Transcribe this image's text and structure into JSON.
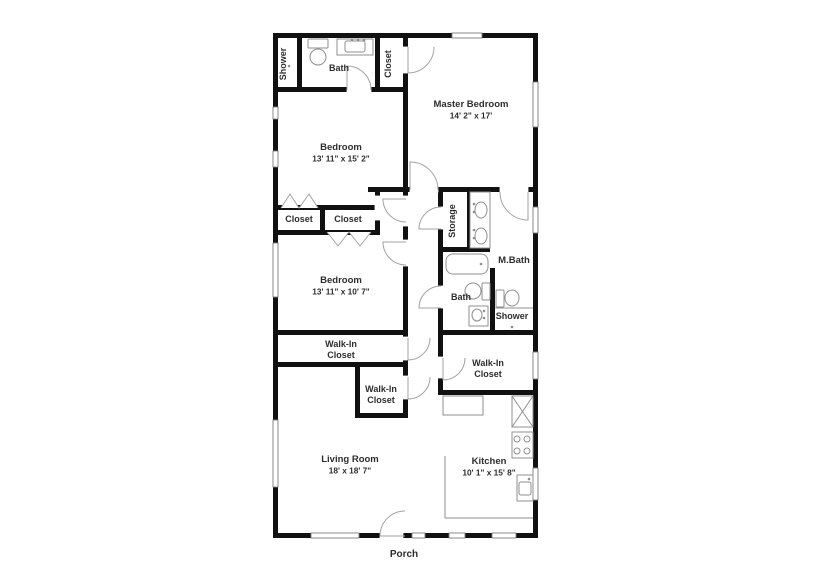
{
  "page": {
    "background": "#ffffff",
    "type": "floor-plan"
  },
  "plan": {
    "colors": {
      "wall": "#111111",
      "fixture": "#8f8f8f",
      "door": "#a3a3a3",
      "window_stroke": "#7d7d7d",
      "text": "#2d2d2d",
      "bg": "#ffffff"
    },
    "walls": [
      [
        273,
        33,
        265,
        5
      ],
      [
        273,
        533,
        265,
        5
      ],
      [
        273,
        33,
        5,
        505
      ],
      [
        533,
        33,
        5,
        505
      ],
      [
        297,
        38,
        5,
        54
      ],
      [
        375,
        38,
        5,
        54
      ],
      [
        403,
        38,
        5,
        380
      ],
      [
        273,
        87,
        130,
        5
      ],
      [
        368,
        187,
        40,
        5
      ],
      [
        375,
        187,
        5,
        48
      ],
      [
        273,
        205,
        105,
        5
      ],
      [
        273,
        230,
        105,
        5
      ],
      [
        320,
        205,
        5,
        30
      ],
      [
        403,
        187,
        135,
        5
      ],
      [
        438,
        190,
        5,
        205
      ],
      [
        467,
        192,
        5,
        58
      ],
      [
        438,
        247,
        52,
        5
      ],
      [
        490,
        268,
        5,
        67
      ],
      [
        273,
        330,
        135,
        5
      ],
      [
        438,
        330,
        100,
        5
      ],
      [
        273,
        362,
        135,
        5
      ],
      [
        355,
        367,
        5,
        51
      ],
      [
        355,
        413,
        53,
        5
      ],
      [
        438,
        390,
        100,
        5
      ]
    ],
    "gaps": [
      [
        403,
        47,
        5,
        26
      ],
      [
        347,
        87,
        24,
        5
      ],
      [
        410,
        187,
        28,
        5
      ],
      [
        500,
        187,
        28,
        5
      ],
      [
        375,
        196,
        5,
        24
      ],
      [
        403,
        196,
        5,
        30
      ],
      [
        403,
        240,
        5,
        26
      ],
      [
        438,
        207,
        5,
        22
      ],
      [
        438,
        286,
        5,
        22
      ],
      [
        403,
        337,
        5,
        23
      ],
      [
        403,
        376,
        5,
        23
      ],
      [
        438,
        357,
        5,
        21
      ],
      [
        380,
        533,
        23,
        5
      ]
    ],
    "windows": [
      [
        452,
        33,
        30,
        5
      ],
      [
        273,
        107,
        5,
        12
      ],
      [
        273,
        151,
        5,
        16
      ],
      [
        273,
        243,
        5,
        54
      ],
      [
        273,
        420,
        5,
        67
      ],
      [
        533,
        82,
        5,
        45
      ],
      [
        533,
        207,
        5,
        26
      ],
      [
        533,
        352,
        5,
        27
      ],
      [
        533,
        468,
        5,
        32
      ],
      [
        311,
        533,
        48,
        5
      ],
      [
        412,
        533,
        13,
        5
      ],
      [
        449,
        533,
        16,
        5
      ],
      [
        492,
        533,
        24,
        5
      ]
    ],
    "doors": [
      "M 408 47 L 408 73 A 26 26 0 0 0 434 47",
      "M 347 90 L 347 66 A 24 24 0 0 1 371 90",
      "M 410 190 L 410 162 A 28 28 0 0 1 438 190",
      "M 528 192 L 528 220 A 28 28 0 0 1 500 192",
      "M 406 199 L 383 199 A 23 23 0 0 0 406 222",
      "M 406 242 L 383 242 A 23 23 0 0 0 406 265",
      "M 441 229 L 419 229 A 22 22 0 0 1 441 207",
      "M 441 308 L 419 308 A 22 22 0 0 1 441 286",
      "M 408 338 L 408 360 A 22 22 0 0 0 430 338",
      "M 408 377 L 408 399 A 22 22 0 0 0 430 377",
      "M 443 358 L 443 380 A 22 22 0 0 0 465 358",
      "M 405 536 L 380 536 A 25 25 0 0 1 405 511"
    ],
    "bifold_doors": [
      "281,208 290,194 299,208 309,194 318,208",
      "327,232 338,246 349,232 360,246 371,232"
    ],
    "fixtures": {
      "rects": [
        [
          308,
          39,
          20,
          9,
          1
        ],
        [
          337,
          39,
          36,
          16,
          0
        ],
        [
          345,
          41,
          20,
          11,
          2
        ],
        [
          470,
          192,
          20,
          56,
          0
        ],
        [
          446,
          254,
          42,
          20,
          7
        ],
        [
          482,
          283,
          8,
          17,
          1
        ],
        [
          496,
          290,
          8,
          17,
          1
        ],
        [
          469,
          306,
          19,
          20,
          0
        ],
        [
          512,
          396,
          21,
          31,
          0
        ],
        [
          512,
          432,
          21,
          26,
          0
        ],
        [
          517,
          475,
          16,
          26,
          0
        ],
        [
          519,
          482,
          12,
          13,
          2
        ],
        [
          443,
          396,
          40,
          19,
          0
        ]
      ],
      "ellipses": [
        [
          318,
          57,
          8,
          8
        ],
        [
          481,
          210,
          6,
          8
        ],
        [
          481,
          236,
          6,
          8
        ],
        [
          473,
          291,
          8,
          8
        ],
        [
          512,
          298,
          7,
          8
        ],
        [
          477,
          315,
          5,
          6
        ]
      ],
      "circles": [
        [
          517,
          439,
          3
        ],
        [
          527,
          439,
          3
        ],
        [
          517,
          451,
          3
        ],
        [
          527,
          451,
          3
        ]
      ],
      "lines": [
        [
          495,
          308,
          533,
          308
        ],
        [
          512,
          396,
          533,
          427
        ],
        [
          533,
          396,
          512,
          427
        ]
      ],
      "polylines": [
        "445,456 445,518 533,518"
      ],
      "dots": [
        [
          289,
          66
        ],
        [
          512,
          327
        ],
        [
          481,
          264
        ],
        [
          474,
          204
        ],
        [
          474,
          212
        ],
        [
          474,
          230
        ],
        [
          474,
          238
        ],
        [
          484,
          311
        ],
        [
          484,
          318
        ],
        [
          352,
          40
        ],
        [
          358,
          40
        ],
        [
          364,
          40
        ],
        [
          529,
          479
        ]
      ]
    },
    "rooms": [
      {
        "id": "shower-1",
        "lines": [
          "Shower"
        ],
        "x": 286,
        "y": 64,
        "rotate": -90,
        "size": 9
      },
      {
        "id": "bath-1",
        "lines": [
          "Bath"
        ],
        "x": 339,
        "y": 71,
        "size": 9
      },
      {
        "id": "closet-hall",
        "lines": [
          "Closet"
        ],
        "x": 391,
        "y": 64,
        "rotate": -90,
        "size": 9
      },
      {
        "id": "master-bedroom",
        "lines": [
          "Master Bedroom"
        ],
        "dims": "14' 2\" x 17'",
        "x": 471,
        "y": 107,
        "size": 9.5
      },
      {
        "id": "bedroom-1",
        "lines": [
          "Bedroom"
        ],
        "dims": "13' 11\" x 15' 2\"",
        "x": 341,
        "y": 150,
        "size": 9.5
      },
      {
        "id": "closet-1",
        "lines": [
          "Closet"
        ],
        "x": 299,
        "y": 222,
        "size": 9
      },
      {
        "id": "closet-2",
        "lines": [
          "Closet"
        ],
        "x": 348,
        "y": 222,
        "size": 9
      },
      {
        "id": "bedroom-2",
        "lines": [
          "Bedroom"
        ],
        "dims": "13' 11\" x 10' 7\"",
        "x": 341,
        "y": 283,
        "size": 9.5
      },
      {
        "id": "storage",
        "lines": [
          "Storage"
        ],
        "x": 455,
        "y": 221,
        "rotate": -90,
        "size": 9
      },
      {
        "id": "m-bath",
        "lines": [
          "M.Bath"
        ],
        "x": 514,
        "y": 263,
        "size": 9.5
      },
      {
        "id": "bath-2",
        "lines": [
          "Bath"
        ],
        "x": 461,
        "y": 300,
        "size": 9
      },
      {
        "id": "shower-2",
        "lines": [
          "Shower"
        ],
        "x": 512,
        "y": 319,
        "size": 9
      },
      {
        "id": "walk-in-closet-1",
        "lines": [
          "Walk-In",
          "Closet"
        ],
        "x": 341,
        "y": 347,
        "size": 9
      },
      {
        "id": "walk-in-closet-2",
        "lines": [
          "Walk-In",
          "Closet"
        ],
        "x": 381,
        "y": 392,
        "size": 9
      },
      {
        "id": "walk-in-closet-3",
        "lines": [
          "Walk-In",
          "Closet"
        ],
        "x": 488,
        "y": 366,
        "size": 9
      },
      {
        "id": "living-room",
        "lines": [
          "Living Room"
        ],
        "dims": "18' x 18' 7\"",
        "x": 350,
        "y": 462,
        "size": 9.5
      },
      {
        "id": "kitchen",
        "lines": [
          "Kitchen"
        ],
        "dims": "10' 1\" x 15' 8\"",
        "x": 489,
        "y": 464,
        "size": 9.5
      },
      {
        "id": "porch",
        "lines": [
          "Porch"
        ],
        "x": 404,
        "y": 557,
        "size": 10
      }
    ]
  }
}
